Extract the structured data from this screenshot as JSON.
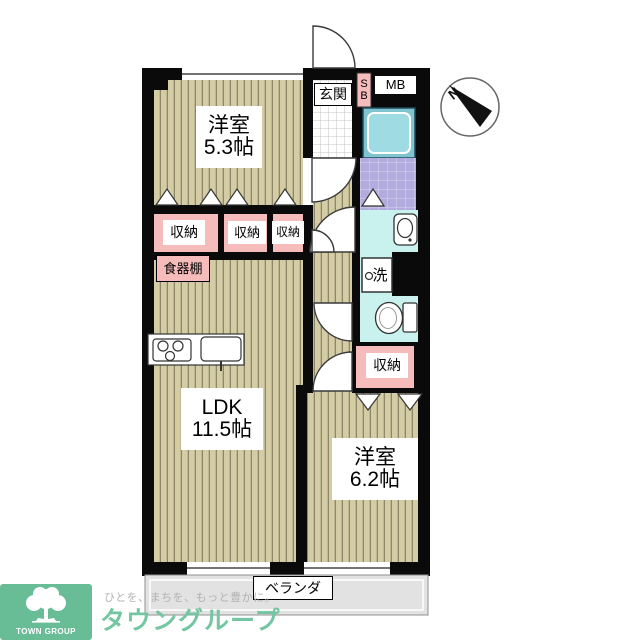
{
  "plan": {
    "entrance": "玄関",
    "shoe_box": "S\nB",
    "meter_box": "MB",
    "room1": {
      "name": "洋室",
      "size": "5.3帖"
    },
    "ldk": {
      "name": "LDK",
      "size": "11.5帖"
    },
    "room2": {
      "name": "洋室",
      "size": "6.2帖"
    },
    "storages": [
      "収納",
      "収納",
      "収納",
      "収納"
    ],
    "cupboard": "食器棚",
    "laundry": "洗",
    "veranda": "ベランダ",
    "compass": "N"
  },
  "branding": {
    "company": "タウングループ",
    "tagline": "ひとを、まちを、もっと豊かに。",
    "logo_text": "TOWN GROUP"
  },
  "colors": {
    "floor_beige": "#d4cca4",
    "floor_stripe": "#8e8668",
    "storage_pink": "#f6bcbc",
    "wet_area_cyan": "#c9f2ef",
    "bath_tile_lavender": "#b2abdd",
    "bathtub_teal": "#7fc4cf",
    "veranda_gray": "#e2e2e2",
    "wall_black": "#0a0a0a",
    "brand_green": "#69bd96"
  }
}
